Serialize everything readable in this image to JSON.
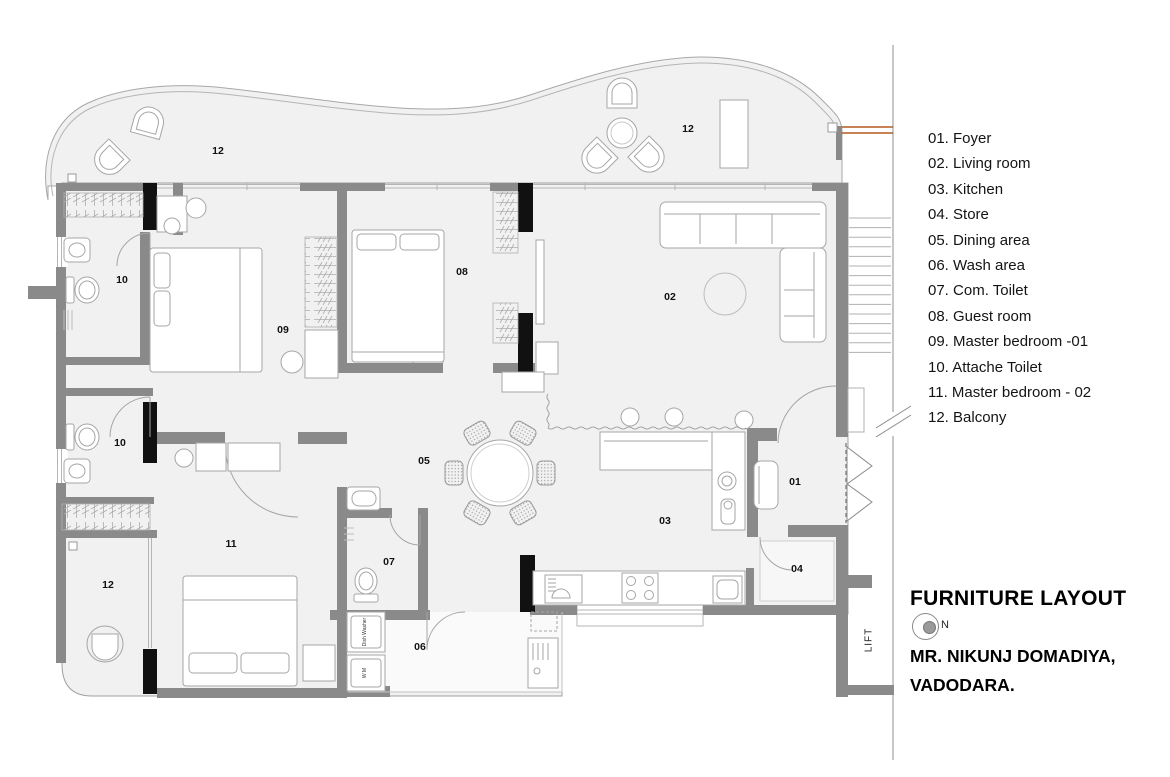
{
  "legend": {
    "items": [
      "01. Foyer",
      "02. Living room",
      "03. Kitchen",
      "04. Store",
      "05. Dining area",
      "06. Wash area",
      "07. Com. Toilet",
      "08. Guest room",
      "09. Master bedroom -01",
      "10. Attache Toilet",
      "11. Master bedroom - 02",
      "12. Balcony"
    ]
  },
  "title_block": {
    "title": "FURNITURE LAYOUT",
    "north_label": "N",
    "client_name": "MR. NIKUNJ DOMADIYA,",
    "client_city": "VADODARA."
  },
  "plan": {
    "room_labels": [
      {
        "text": "12",
        "x": 218,
        "y": 151
      },
      {
        "text": "12",
        "x": 688,
        "y": 129
      },
      {
        "text": "10",
        "x": 122,
        "y": 280
      },
      {
        "text": "09",
        "x": 283,
        "y": 330
      },
      {
        "text": "08",
        "x": 462,
        "y": 272
      },
      {
        "text": "02",
        "x": 670,
        "y": 297
      },
      {
        "text": "10",
        "x": 120,
        "y": 443
      },
      {
        "text": "05",
        "x": 424,
        "y": 461
      },
      {
        "text": "01",
        "x": 795,
        "y": 482
      },
      {
        "text": "03",
        "x": 665,
        "y": 521
      },
      {
        "text": "11",
        "x": 231,
        "y": 544
      },
      {
        "text": "07",
        "x": 389,
        "y": 562
      },
      {
        "text": "04",
        "x": 797,
        "y": 569
      },
      {
        "text": "12",
        "x": 108,
        "y": 585
      },
      {
        "text": "06",
        "x": 420,
        "y": 647
      }
    ],
    "lift_label": "LIFT",
    "appliance_labels": {
      "dish_washer": "Dish Washer",
      "washing_machine": "W M"
    },
    "colors": {
      "wall": "#8a8a8a",
      "column": "#111111",
      "floor": "#f1f1f1",
      "furniture_line": "#a6a6a6",
      "window_line": "#b5b5b5",
      "accent_orange": "#b35a1f"
    }
  }
}
